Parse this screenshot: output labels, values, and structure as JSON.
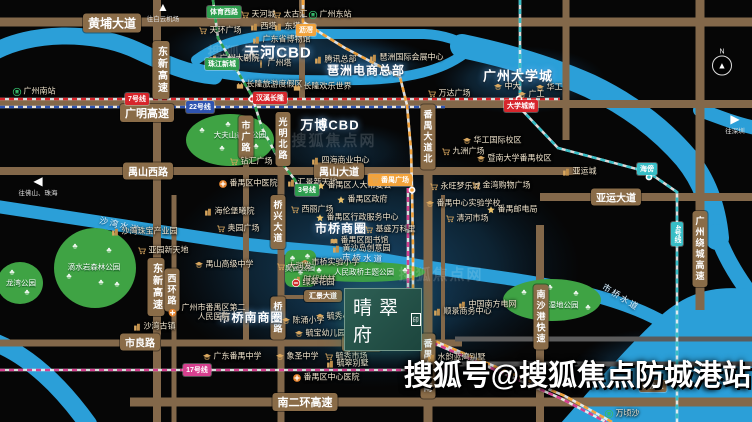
{
  "canvas": {
    "w": 752,
    "h": 422,
    "bg": "#060606"
  },
  "colors": {
    "road": "#83684a",
    "road_thin": "#5b5b5b",
    "river": "#2b9fd8",
    "park": "#3fa344",
    "glow": "#1d537c",
    "metro_red": "#d7262c",
    "metro_blue": "#2f54b0",
    "metro_green": "#2f9e4f",
    "metro_orange": "#f2a33c",
    "metro_teal": "#38bec6",
    "metro_magenta": "#d6408f",
    "tag_brown": "#8a6c48"
  },
  "project": {
    "name": "晴翠府",
    "seal": "印",
    "x": 344,
    "y": 288,
    "w": 76,
    "h": 61
  },
  "watermark_big": {
    "text": "搜狐号@搜狐焦点防城港站"
  },
  "watermarks": [
    {
      "text": "搜狐焦点网",
      "x": 250,
      "y": 52
    },
    {
      "text": "搜狐焦点网",
      "x": 334,
      "y": 140
    },
    {
      "text": "搜狐焦点网",
      "x": 441,
      "y": 274
    }
  ],
  "compass": {
    "letter": "N",
    "x": 722,
    "y": 62
  },
  "arrows": [
    {
      "dir": "up",
      "glyph": "▲",
      "text": "往白云机场",
      "x": 163,
      "y": 12
    },
    {
      "dir": "left",
      "glyph": "◀",
      "text": "往佛山、珠海",
      "x": 38,
      "y": 186
    },
    {
      "dir": "right",
      "glyph": "▶",
      "text": "往深圳",
      "x": 735,
      "y": 124
    }
  ],
  "glows": [
    {
      "cx": 278,
      "cy": 50,
      "rx": 118,
      "ry": 36,
      "o": 0.8
    },
    {
      "cx": 366,
      "cy": 64,
      "rx": 68,
      "ry": 26,
      "o": 0.7
    },
    {
      "cx": 520,
      "cy": 80,
      "rx": 86,
      "ry": 34,
      "o": 0.8
    },
    {
      "cx": 340,
      "cy": 150,
      "rx": 80,
      "ry": 28,
      "o": 0.5
    },
    {
      "cx": 372,
      "cy": 268,
      "rx": 208,
      "ry": 120,
      "o": 0.9
    },
    {
      "cx": 382,
      "cy": 305,
      "rx": 100,
      "ry": 66,
      "o": 0.55
    },
    {
      "cx": 660,
      "cy": 372,
      "rx": 88,
      "ry": 44,
      "o": 0.85
    }
  ],
  "rivers": {
    "strokes": [
      {
        "d": "M-6,52 C30,32 92,30 136,50 C166,64 188,74 214,76",
        "w": 17
      },
      {
        "d": "M196,60 C228,36 268,34 310,34 L424,34 C448,35 462,42 472,50",
        "w": 10
      },
      {
        "d": "M196,68 C240,80 300,81 360,80 C410,79 442,70 464,54",
        "w": 10
      },
      {
        "d": "M462,46 C505,55 550,68 590,86 C632,106 662,130 686,158 C704,180 714,206 717,238",
        "w": 24
      },
      {
        "d": "M700,110 C724,119 740,125 756,128",
        "w": 14
      },
      {
        "d": "M716,232 C724,254 734,272 750,294",
        "w": 16
      },
      {
        "d": "M-6,206 C70,218 150,230 230,242 C300,252 340,250 385,260 C450,272 520,278 577,291 C622,302 648,313 668,325",
        "w": 13
      },
      {
        "d": "M-6,342 C30,356 62,388 88,424",
        "w": 18
      }
    ],
    "fills": [
      {
        "d": "M560,424 C592,388 622,352 656,320 C686,292 714,284 756,290 L756,424 Z"
      }
    ]
  },
  "river_labels": [
    {
      "text": "沙湾水道",
      "x": 120,
      "y": 225,
      "rot": 14
    },
    {
      "text": "市桥水道",
      "x": 363,
      "y": 258,
      "rot": 3
    },
    {
      "text": "市桥水道",
      "x": 621,
      "y": 297,
      "rot": 32
    }
  ],
  "roads": {
    "h": [
      {
        "x1": 0,
        "x2": 752,
        "y": 22,
        "w": 9
      },
      {
        "x1": 0,
        "x2": 752,
        "y": 104,
        "w": 8
      },
      {
        "x1": 0,
        "x2": 580,
        "y": 171,
        "w": 8
      },
      {
        "x1": 540,
        "x2": 752,
        "y": 197,
        "w": 8
      },
      {
        "x1": 278,
        "x2": 342,
        "y": 297,
        "w": 4
      },
      {
        "x1": 0,
        "x2": 462,
        "y": 343,
        "w": 7
      },
      {
        "x1": 455,
        "x2": 752,
        "y": 339,
        "w": 5,
        "c": "#5b5b5b"
      },
      {
        "x1": 455,
        "x2": 752,
        "y": 364,
        "w": 5,
        "c": "#5b5b5b"
      },
      {
        "x1": 130,
        "x2": 752,
        "y": 402,
        "w": 9
      }
    ],
    "v": [
      {
        "x": 157,
        "y1": 0,
        "y2": 422,
        "w": 8
      },
      {
        "x": 174,
        "y1": 195,
        "y2": 422,
        "w": 5
      },
      {
        "x": 246,
        "y1": 150,
        "y2": 345,
        "w": 6
      },
      {
        "x": 281,
        "y1": 112,
        "y2": 422,
        "w": 7
      },
      {
        "x": 302,
        "y1": 0,
        "y2": 104,
        "w": 6
      },
      {
        "x": 428,
        "y1": 100,
        "y2": 422,
        "w": 9
      },
      {
        "x": 443,
        "y1": 195,
        "y2": 345,
        "w": 4
      },
      {
        "x": 540,
        "y1": 225,
        "y2": 422,
        "w": 8
      },
      {
        "x": 566,
        "y1": 0,
        "y2": 140,
        "w": 7
      },
      {
        "x": 700,
        "y1": 0,
        "y2": 310,
        "w": 9
      }
    ]
  },
  "road_labels": [
    {
      "text": "黄埔大道",
      "x": 112,
      "y": 23,
      "size": 12
    },
    {
      "text": "广明高速",
      "x": 147,
      "y": 113,
      "size": 11
    },
    {
      "text": "禺山西路",
      "x": 148,
      "y": 171,
      "size": 10
    },
    {
      "text": "禺山大道",
      "x": 339,
      "y": 171,
      "size": 10
    },
    {
      "text": "亚运大道",
      "x": 616,
      "y": 197,
      "size": 10
    },
    {
      "text": "市良路",
      "x": 140,
      "y": 342,
      "size": 10
    },
    {
      "text": "市南路",
      "x": 362,
      "y": 343,
      "size": 10
    },
    {
      "text": "南二环高速",
      "x": 305,
      "y": 402,
      "size": 11
    },
    {
      "text": "汇景大道",
      "x": 323,
      "y": 296,
      "size": 7
    },
    {
      "text": "东新高速",
      "x": 161,
      "y": 70,
      "size": 10,
      "v": true
    },
    {
      "text": "东新高速",
      "x": 156,
      "y": 287,
      "size": 10,
      "v": true
    },
    {
      "text": "市广路",
      "x": 246,
      "y": 137,
      "size": 9,
      "v": true
    },
    {
      "text": "光明北路",
      "x": 283,
      "y": 139,
      "size": 9,
      "v": true
    },
    {
      "text": "桥兴大道",
      "x": 278,
      "y": 222,
      "size": 9,
      "v": true
    },
    {
      "text": "桥南路",
      "x": 278,
      "y": 318,
      "size": 9,
      "v": true
    },
    {
      "text": "西环路",
      "x": 172,
      "y": 290,
      "size": 9,
      "v": true
    },
    {
      "text": "番禺大道北",
      "x": 428,
      "y": 137,
      "size": 9,
      "v": true
    },
    {
      "text": "番禺大道南",
      "x": 428,
      "y": 366,
      "size": 9,
      "v": true
    },
    {
      "text": "南沙港快速",
      "x": 541,
      "y": 317,
      "size": 9,
      "v": true
    },
    {
      "text": "广州绕城高速",
      "x": 700,
      "y": 249,
      "size": 9,
      "v": true
    }
  ],
  "metro_lines": [
    {
      "name": "7号线",
      "color": "#d7262c",
      "pts": [
        [
          0,
          99
        ],
        [
          560,
          99
        ]
      ]
    },
    {
      "name": "22号线",
      "color": "#2f54b0",
      "pts": [
        [
          0,
          107
        ],
        [
          445,
          107
        ]
      ]
    },
    {
      "name": "3号线",
      "color": "#2f9e4f",
      "pts": [
        [
          213,
          0
        ],
        [
          218,
          38
        ],
        [
          252,
          96
        ],
        [
          262,
          128
        ],
        [
          278,
          158
        ],
        [
          295,
          180
        ],
        [
          300,
          192
        ]
      ]
    },
    {
      "name": "3号线延长",
      "color": "#f2a33c",
      "pts": [
        [
          303,
          0
        ],
        [
          303,
          22
        ],
        [
          345,
          48
        ],
        [
          400,
          77
        ],
        [
          407,
          105
        ],
        [
          411,
          150
        ],
        [
          412,
          188
        ],
        [
          413,
          250
        ],
        [
          413,
          332
        ],
        [
          565,
          396
        ],
        [
          612,
          422
        ]
      ]
    },
    {
      "name": "18号线",
      "color": "#d6408f",
      "pts": [
        [
          408,
          188
        ],
        [
          408,
          332
        ],
        [
          560,
          398
        ],
        [
          606,
          422
        ]
      ]
    },
    {
      "name": "4号线",
      "color": "#38bec6",
      "pts": [
        [
          520,
          0
        ],
        [
          520,
          108
        ],
        [
          558,
          148
        ],
        [
          648,
          172
        ],
        [
          677,
          192
        ],
        [
          677,
          422
        ]
      ]
    },
    {
      "name": "17号线",
      "color": "#d6408f",
      "pts": [
        [
          0,
          370
        ],
        [
          455,
          370
        ]
      ]
    }
  ],
  "stations": [
    {
      "x": 252,
      "y": 99,
      "c": "#d7262c"
    },
    {
      "x": 519,
      "y": 99,
      "c": "#d7262c"
    },
    {
      "x": 412,
      "y": 190,
      "c": "#f2a33c"
    },
    {
      "x": 649,
      "y": 177,
      "c": "#38bec6"
    }
  ],
  "metro_tags": [
    {
      "text": "7号线",
      "x": 137,
      "y": 99,
      "c": "#d7262c"
    },
    {
      "text": "22号线",
      "x": 200,
      "y": 107,
      "c": "#2f54b0"
    },
    {
      "text": "3号线",
      "x": 307,
      "y": 190,
      "c": "#2f9e4f"
    },
    {
      "text": "17号线",
      "x": 197,
      "y": 370,
      "c": "#d6408f"
    },
    {
      "text": "4号线",
      "x": 677,
      "y": 234,
      "c": "#38bec6",
      "v": true
    },
    {
      "text": "体育西路",
      "x": 224,
      "y": 12,
      "c": "#2f9e4f"
    },
    {
      "text": "珠江新城",
      "x": 222,
      "y": 64,
      "c": "#2f9e4f"
    },
    {
      "text": "汉溪长隆",
      "x": 270,
      "y": 98,
      "c": "#d7262c"
    },
    {
      "text": "大学城南",
      "x": 521,
      "y": 106,
      "c": "#d7262c"
    },
    {
      "text": "沥滘",
      "x": 306,
      "y": 30,
      "c": "#f2a33c"
    },
    {
      "text": "海傍",
      "x": 647,
      "y": 169,
      "c": "#38bec6"
    },
    {
      "text": "番禺广场",
      "x": 390,
      "y": 180,
      "c": "#f2a33c",
      "cart": true
    },
    {
      "text": "南沙区",
      "x": 653,
      "y": 386,
      "c": "#8a6c48"
    }
  ],
  "parks": [
    {
      "shape": "ellipse",
      "cx": 230,
      "cy": 140,
      "rx": 44,
      "ry": 26,
      "label": "大夫山森林公园",
      "lx": 240,
      "ly": 135,
      "trees": [
        [
          -28,
          -10
        ],
        [
          -8,
          8
        ],
        [
          12,
          -8
        ],
        [
          26,
          6
        ],
        [
          -2,
          -16
        ]
      ]
    },
    {
      "shape": "ellipse",
      "cx": 95,
      "cy": 268,
      "rx": 41,
      "ry": 40,
      "label": "滴水岩森林公园",
      "lx": 94,
      "ly": 267,
      "trees": [
        [
          -20,
          -22
        ],
        [
          14,
          -18
        ],
        [
          -26,
          8
        ],
        [
          6,
          14
        ],
        [
          22,
          16
        ]
      ]
    },
    {
      "shape": "ellipse",
      "cx": 20,
      "cy": 283,
      "rx": 23,
      "ry": 21,
      "label": "龙湾公园",
      "lx": 21,
      "ly": 283,
      "trees": [
        [
          -8,
          -11
        ],
        [
          7,
          9
        ]
      ]
    },
    {
      "shape": "rect",
      "x": 285,
      "y": 250,
      "w": 31,
      "h": 37,
      "r": 7,
      "label": "奥园公园",
      "lx": 300,
      "ly": 268,
      "trees": [
        [
          -8,
          -11
        ],
        [
          7,
          -13
        ],
        [
          0,
          3
        ]
      ]
    },
    {
      "shape": "ellipse",
      "cx": 363,
      "cy": 272,
      "rx": 62,
      "ry": 10,
      "label": "人民政桥主题公园",
      "lx": 364,
      "ly": 272,
      "trees": [
        [
          -44,
          -2
        ],
        [
          42,
          -2
        ]
      ]
    },
    {
      "shape": "ellipse",
      "cx": 552,
      "cy": 300,
      "rx": 49,
      "ry": 21,
      "label": "草河湿地公园",
      "lx": 556,
      "ly": 305,
      "trees": [
        [
          -28,
          -8
        ],
        [
          -2,
          -13
        ],
        [
          24,
          -7
        ],
        [
          36,
          7
        ]
      ]
    }
  ],
  "big_labels": [
    {
      "text": "天河CBD",
      "x": 278,
      "y": 52,
      "size": 15
    },
    {
      "text": "万博CBD",
      "x": 330,
      "y": 124,
      "size": 13
    },
    {
      "text": "琶洲电商总部",
      "x": 366,
      "y": 70,
      "size": 12
    },
    {
      "text": "广州大学城",
      "x": 518,
      "y": 75,
      "size": 13
    },
    {
      "text": "市桥商圈",
      "x": 341,
      "y": 228,
      "size": 12
    },
    {
      "text": "市桥南商圈",
      "x": 251,
      "y": 317,
      "size": 12
    }
  ],
  "pois": [
    {
      "type": "cart",
      "text": "天河城",
      "x": 258,
      "y": 15
    },
    {
      "type": "cart",
      "text": "太古汇",
      "x": 290,
      "y": 15
    },
    {
      "type": "rail",
      "text": "广州东站",
      "x": 330,
      "y": 15
    },
    {
      "type": "cart",
      "text": "天环广场",
      "x": 220,
      "y": 31
    },
    {
      "type": "building",
      "text": "西塔",
      "x": 263,
      "y": 27
    },
    {
      "type": "building",
      "text": "东塔",
      "x": 287,
      "y": 27
    },
    {
      "type": "building",
      "text": "广东省博物馆",
      "x": 281,
      "y": 40
    },
    {
      "type": "tower",
      "text": "广州塔",
      "x": 274,
      "y": 64
    },
    {
      "type": "building",
      "text": "广州大剧院",
      "x": 234,
      "y": 59
    },
    {
      "type": "building",
      "text": "腾讯总部",
      "x": 335,
      "y": 60
    },
    {
      "type": "building",
      "text": "琶洲国际会展中心",
      "x": 406,
      "y": 58
    },
    {
      "type": "castle",
      "text": "长隆旅游度假区",
      "x": 269,
      "y": 85
    },
    {
      "type": "castle",
      "text": "长隆欢乐世界",
      "x": 322,
      "y": 87
    },
    {
      "type": "rail",
      "text": "广州南站",
      "x": 34,
      "y": 92
    },
    {
      "type": "cart",
      "text": "万达广场",
      "x": 449,
      "y": 94
    },
    {
      "type": "school",
      "text": "中大",
      "x": 507,
      "y": 87
    },
    {
      "type": "school",
      "text": "广工",
      "x": 531,
      "y": 95
    },
    {
      "type": "school",
      "text": "华工",
      "x": 549,
      "y": 88
    },
    {
      "type": "school",
      "text": "华工国际校区",
      "x": 492,
      "y": 141
    },
    {
      "type": "school",
      "text": "暨南大学番禺校区",
      "x": 514,
      "y": 159
    },
    {
      "type": "cart",
      "text": "永旺梦乐城",
      "x": 455,
      "y": 187
    },
    {
      "type": "cart",
      "text": "金湾购物广场",
      "x": 501,
      "y": 186
    },
    {
      "type": "school",
      "text": "番禺中心实验学校",
      "x": 463,
      "y": 204
    },
    {
      "type": "star",
      "text": "番禺邮电局",
      "x": 512,
      "y": 210
    },
    {
      "type": "cart",
      "text": "清河市场",
      "x": 467,
      "y": 219
    },
    {
      "type": "building",
      "text": "亚运城",
      "x": 579,
      "y": 172
    },
    {
      "type": "building",
      "text": "四海商业中心",
      "x": 340,
      "y": 161
    },
    {
      "type": "cart",
      "text": "九洲广场",
      "x": 463,
      "y": 152
    },
    {
      "type": "cart",
      "text": "钻汇广场",
      "x": 251,
      "y": 162
    },
    {
      "type": "building",
      "text": "汇景新天地",
      "x": 312,
      "y": 183
    },
    {
      "type": "star",
      "text": "番禺区人大常委会",
      "x": 354,
      "y": 186
    },
    {
      "type": "star",
      "text": "番禺区政府",
      "x": 362,
      "y": 200
    },
    {
      "type": "star",
      "text": "番禺区行政服务中心",
      "x": 357,
      "y": 218
    },
    {
      "type": "hospital",
      "text": "番禺区中医院",
      "x": 248,
      "y": 184
    },
    {
      "type": "cart",
      "text": "西丽广场",
      "x": 312,
      "y": 210
    },
    {
      "type": "building",
      "text": "海伦堡曦院",
      "x": 229,
      "y": 212
    },
    {
      "type": "cart",
      "text": "奥园广场",
      "x": 238,
      "y": 229
    },
    {
      "type": "building",
      "text": "沙湾珠宝产业园",
      "x": 144,
      "y": 232
    },
    {
      "type": "cart",
      "text": "亚园新天地",
      "x": 163,
      "y": 251
    },
    {
      "type": "school",
      "text": "禺山高级中学",
      "x": 224,
      "y": 265
    },
    {
      "type": "building",
      "text": "时代柏林",
      "x": 314,
      "y": 280
    },
    {
      "type": "school",
      "text": "市桥实验小学",
      "x": 330,
      "y": 263
    },
    {
      "type": "cart",
      "text": "大润发",
      "x": 294,
      "y": 267
    },
    {
      "type": "cart",
      "text": "基盛万科里",
      "x": 390,
      "y": 230
    },
    {
      "type": "book",
      "text": "番禺区图书馆",
      "x": 359,
      "y": 241
    },
    {
      "type": "building",
      "text": "黄沙岛创意园",
      "x": 361,
      "y": 249
    },
    {
      "type": "school",
      "text": "陈涌小学",
      "x": 303,
      "y": 321
    },
    {
      "type": "school",
      "text": "毓秀小学",
      "x": 337,
      "y": 317
    },
    {
      "type": "school",
      "text": "毓宝幼儿园",
      "x": 320,
      "y": 334
    },
    {
      "type": "school",
      "text": "象圣中学",
      "x": 297,
      "y": 357
    },
    {
      "type": "cart",
      "text": "毓秀市场",
      "x": 346,
      "y": 357
    },
    {
      "type": "building",
      "text": "毓翠别墅",
      "x": 347,
      "y": 364
    },
    {
      "type": "school",
      "text": "广东番禺中学",
      "x": 232,
      "y": 357
    },
    {
      "type": "hospital",
      "text": "番禺区中心医院",
      "x": 326,
      "y": 378
    },
    {
      "type": "hospital",
      "text": "广州市番禺区第二人民医院",
      "x": 208,
      "y": 313,
      "w": 80
    },
    {
      "type": "building",
      "text": "沙湾古镇",
      "x": 154,
      "y": 327
    },
    {
      "type": "building",
      "text": "中国南方电网",
      "x": 487,
      "y": 305
    },
    {
      "type": "building",
      "text": "顺景商务中心",
      "x": 462,
      "y": 312
    },
    {
      "type": "building",
      "text": "水韵蓝湾别墅",
      "x": 456,
      "y": 358
    },
    {
      "type": "rail",
      "text": "万顷沙",
      "x": 622,
      "y": 414
    },
    {
      "type": "station",
      "text": "绿翠花园",
      "x": 313,
      "y": 283
    }
  ]
}
